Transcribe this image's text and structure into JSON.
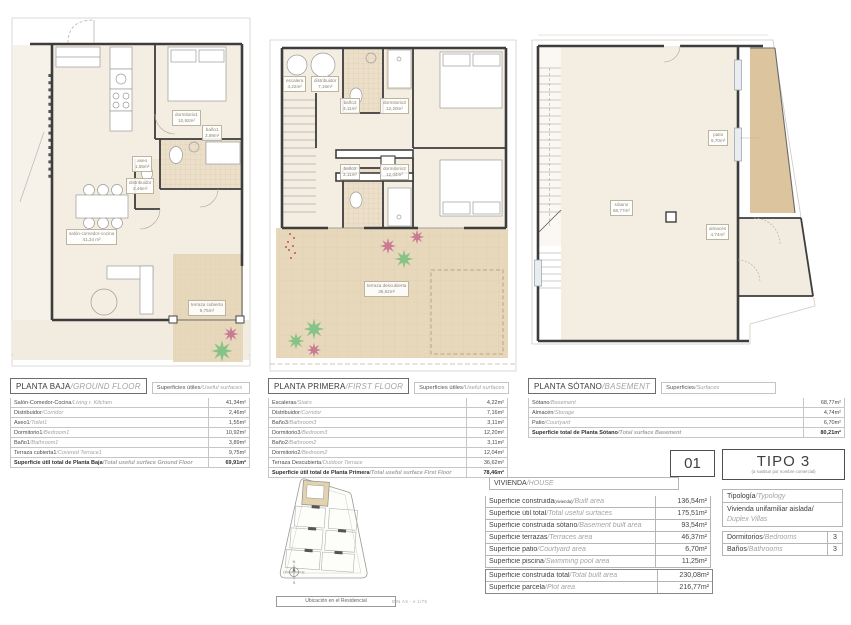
{
  "plans": [
    {
      "name": "PLANTA BAJA",
      "name_en": "/GROUND FLOOR",
      "surfaces": "Superficies útiles",
      "surfaces_en": "/Useful surfaces",
      "rows": [
        {
          "es": "Salón-Comedor-Cocina",
          "en": "/Living r. Kitchen",
          "v": "41,34m²"
        },
        {
          "es": "Distribuidor",
          "en": "/Corridor",
          "v": "2,46m²"
        },
        {
          "es": "Aseo1",
          "en": "/Toilet1",
          "v": "1,55m²"
        },
        {
          "es": "Dormitorio1",
          "en": "/Bedroom1",
          "v": "10,92m²"
        },
        {
          "es": "Baño1",
          "en": "/Bathroom1",
          "v": "3,89m²"
        },
        {
          "es": "Terraza cubierta1",
          "en": "/Covered Terrace1",
          "v": "9,75m²"
        },
        {
          "es": "Superficie útil total de Planta Baja",
          "en": "/Total useful surface Ground Floor",
          "v": "69,91m²",
          "total": true
        }
      ],
      "labels": [
        {
          "t": "dormitorio1",
          "a": "10,92m²"
        },
        {
          "t": "baño1",
          "a": "3,89m²"
        },
        {
          "t": "aseo",
          "a": "1,55m²"
        },
        {
          "t": "distribuidor",
          "a": "2,46m²"
        },
        {
          "t": "salón-comedor-cocina",
          "a": "41,34 m²"
        },
        {
          "t": "terraza cubierta",
          "a": "9,75m²"
        }
      ]
    },
    {
      "name": "PLANTA PRIMERA",
      "name_en": "/FIRST FLOOR",
      "surfaces": "Superficies útiles",
      "surfaces_en": "/Useful surfaces",
      "rows": [
        {
          "es": "Escaleras",
          "en": "/Stairs",
          "v": "4,22m²"
        },
        {
          "es": "Distribuidor",
          "en": "/Corridor",
          "v": "7,16m²"
        },
        {
          "es": "Baño3",
          "en": "/Bathroom3",
          "v": "3,11m²"
        },
        {
          "es": "Dormitorio3",
          "en": "/Bedroom3",
          "v": "12,20m²"
        },
        {
          "es": "Baño2",
          "en": "/Bathroom2",
          "v": "3,11m²"
        },
        {
          "es": "Dormitorio2",
          "en": "/Bedroom2",
          "v": "12,04m²"
        },
        {
          "es": "Terraza Descubierta",
          "en": "/Outdoor Terrace",
          "v": "36,62m²"
        },
        {
          "es": "Superficie útil total de Planta Primera",
          "en": "/Total useful surface First Floor",
          "v": "78,46m²",
          "total": true
        }
      ],
      "labels": [
        {
          "t": "escalera",
          "a": "4,22m²"
        },
        {
          "t": "distribuidor",
          "a": "7,16m²"
        },
        {
          "t": "baño3",
          "a": "3,11m²"
        },
        {
          "t": "dormitorio3",
          "a": "12,20m²"
        },
        {
          "t": "baño2",
          "a": "3,11m²"
        },
        {
          "t": "dormitorio2",
          "a": "12,04m²"
        },
        {
          "t": "terraza descubierta",
          "a": "36,62m²"
        }
      ]
    },
    {
      "name": "PLANTA SÓTANO",
      "name_en": "/BASEMENT",
      "surfaces": "Superficies",
      "surfaces_en": "/Surfaces",
      "rows": [
        {
          "es": "Sótano",
          "en": "/Basement",
          "v": "68,77m²"
        },
        {
          "es": "Almacén",
          "en": "/Storage",
          "v": "4,74m²"
        },
        {
          "es": "Patio",
          "en": "/Courtyard",
          "v": "6,70m²"
        },
        {
          "es": "Superficie total de Planta Sótano",
          "en": "/Total surface Basement",
          "v": "80,21m²",
          "total": true
        }
      ],
      "labels": [
        {
          "t": "sótano",
          "a": "68,77m²"
        },
        {
          "t": "patio",
          "a": "6,70m²"
        },
        {
          "t": "almacén",
          "a": "4,74m²"
        }
      ]
    }
  ],
  "house": {
    "title": "VIVIENDA",
    "title_en": "/HOUSE",
    "rows": [
      {
        "es": "Superficie construida",
        "es_sub": "(vivienda)",
        "en": "/Built area",
        "v": "136,54m²"
      },
      {
        "es": "Superficie útil total",
        "en": "/Total useful surfaces",
        "v": "175,51m²"
      },
      {
        "es": "Superficie construida sótano",
        "en": "/Basement built area",
        "v": "93,54m²"
      },
      {
        "es": "Superficie terrazas",
        "en": "/Terraces area",
        "v": "46,37m²"
      },
      {
        "es": "Superficie patio",
        "en": "/Courtyard area",
        "v": "6,70m²"
      },
      {
        "es": "Superficie piscina",
        "en": "/Swimming pool area",
        "v": "11,25m²"
      }
    ],
    "totals": [
      {
        "es": "Superficie construida total",
        "en": "/Total built area",
        "v": "230,08m²"
      },
      {
        "es": "Superficie parcela",
        "en": "/Plot area",
        "v": "216,77m²"
      }
    ]
  },
  "unit": {
    "number": "01",
    "type": "TIPO 3",
    "type_note": "(a sustituir por nombre comercial)"
  },
  "typology": {
    "header": "Tipología",
    "header_en": "/Typology",
    "value": "Vivienda unifamiliar aislada/",
    "value_en": "Duplex Villas",
    "specs": [
      {
        "es": "Dormitorios",
        "en": "/Bedrooms",
        "v": "3"
      },
      {
        "es": "Baños",
        "en": "/Bathrooms",
        "v": "3"
      }
    ]
  },
  "site": {
    "caption": "Ubicación en el Residencial",
    "compass": {
      "n": "N",
      "s": "S",
      "e": "E",
      "w": "O"
    }
  },
  "footer": {
    "scale": "DIN A3 - e 1/75"
  },
  "colors": {
    "room_fill": "#f4ede2",
    "terrace_fill": "#e8d8bb",
    "patio_fill": "#dcc59e",
    "wall": "#3d3d3d",
    "plant_green": "#87c287",
    "plant_pink": "#c97b94"
  }
}
